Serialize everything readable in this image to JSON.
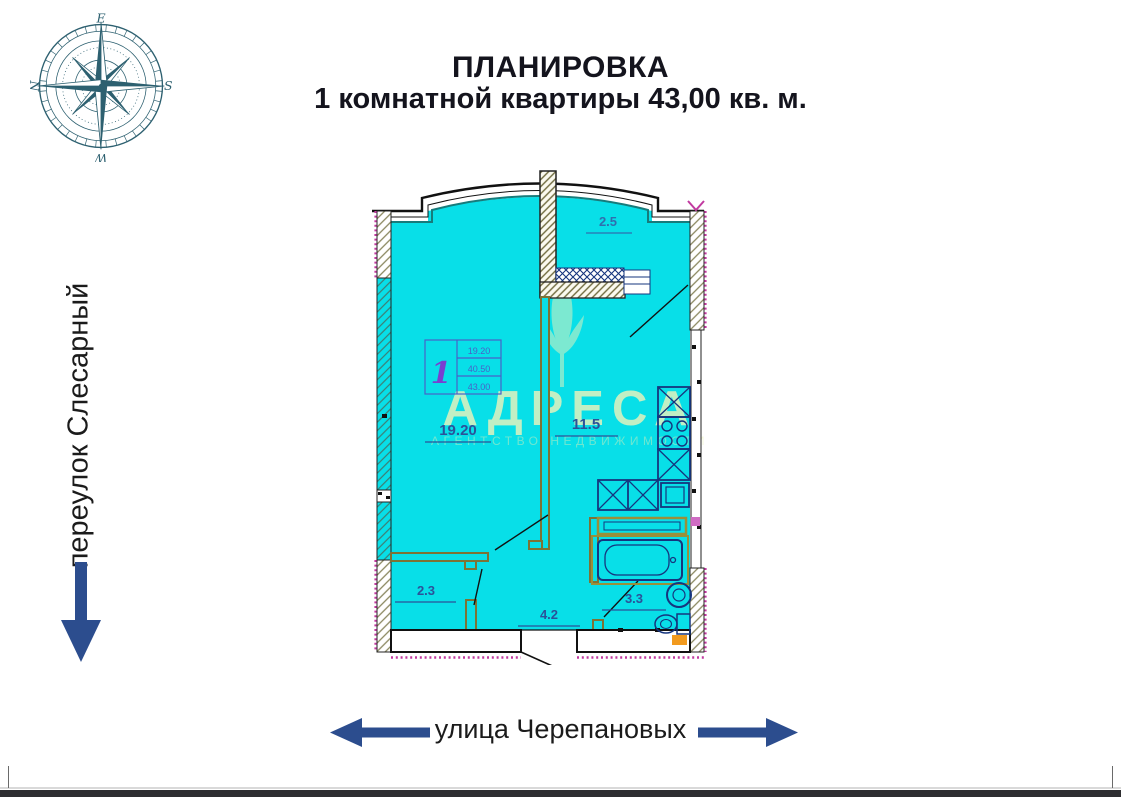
{
  "title": {
    "line1": "ПЛАНИРОВКА",
    "line2": "1 комнатной квартиры 43,00 кв. м."
  },
  "streets": {
    "left_vertical": "переулок Слесарный",
    "bottom": "улица Черепановых"
  },
  "compass": {
    "east": "E",
    "south": "S",
    "west": "W",
    "north": "N"
  },
  "plan": {
    "room_areas": {
      "living": "19.20",
      "kitchen": "11.5",
      "balcony": "2.5",
      "closet": "2.3",
      "hallway": "4.2",
      "bathroom": "3.3"
    },
    "info_table": {
      "unit_number": "1",
      "living_area": "19.20",
      "area_no_balcony": "40.50",
      "total_area": "43.00"
    }
  },
  "watermark": {
    "name": "АДРЕСА",
    "tagline": "АГЕНТСТВО НЕДВИЖИМОСТИ"
  },
  "colors": {
    "room_fill": "#08dfe8",
    "fixture_line": "#16357e",
    "partition_olive": "#7d7335",
    "label_blue": "#2b5299",
    "arrow_blue": "#2c4d8e",
    "compass_teal": "#2d6070",
    "watermark_yellow": "#f0f4bc",
    "magenta_hatch": "#c13aa0"
  }
}
